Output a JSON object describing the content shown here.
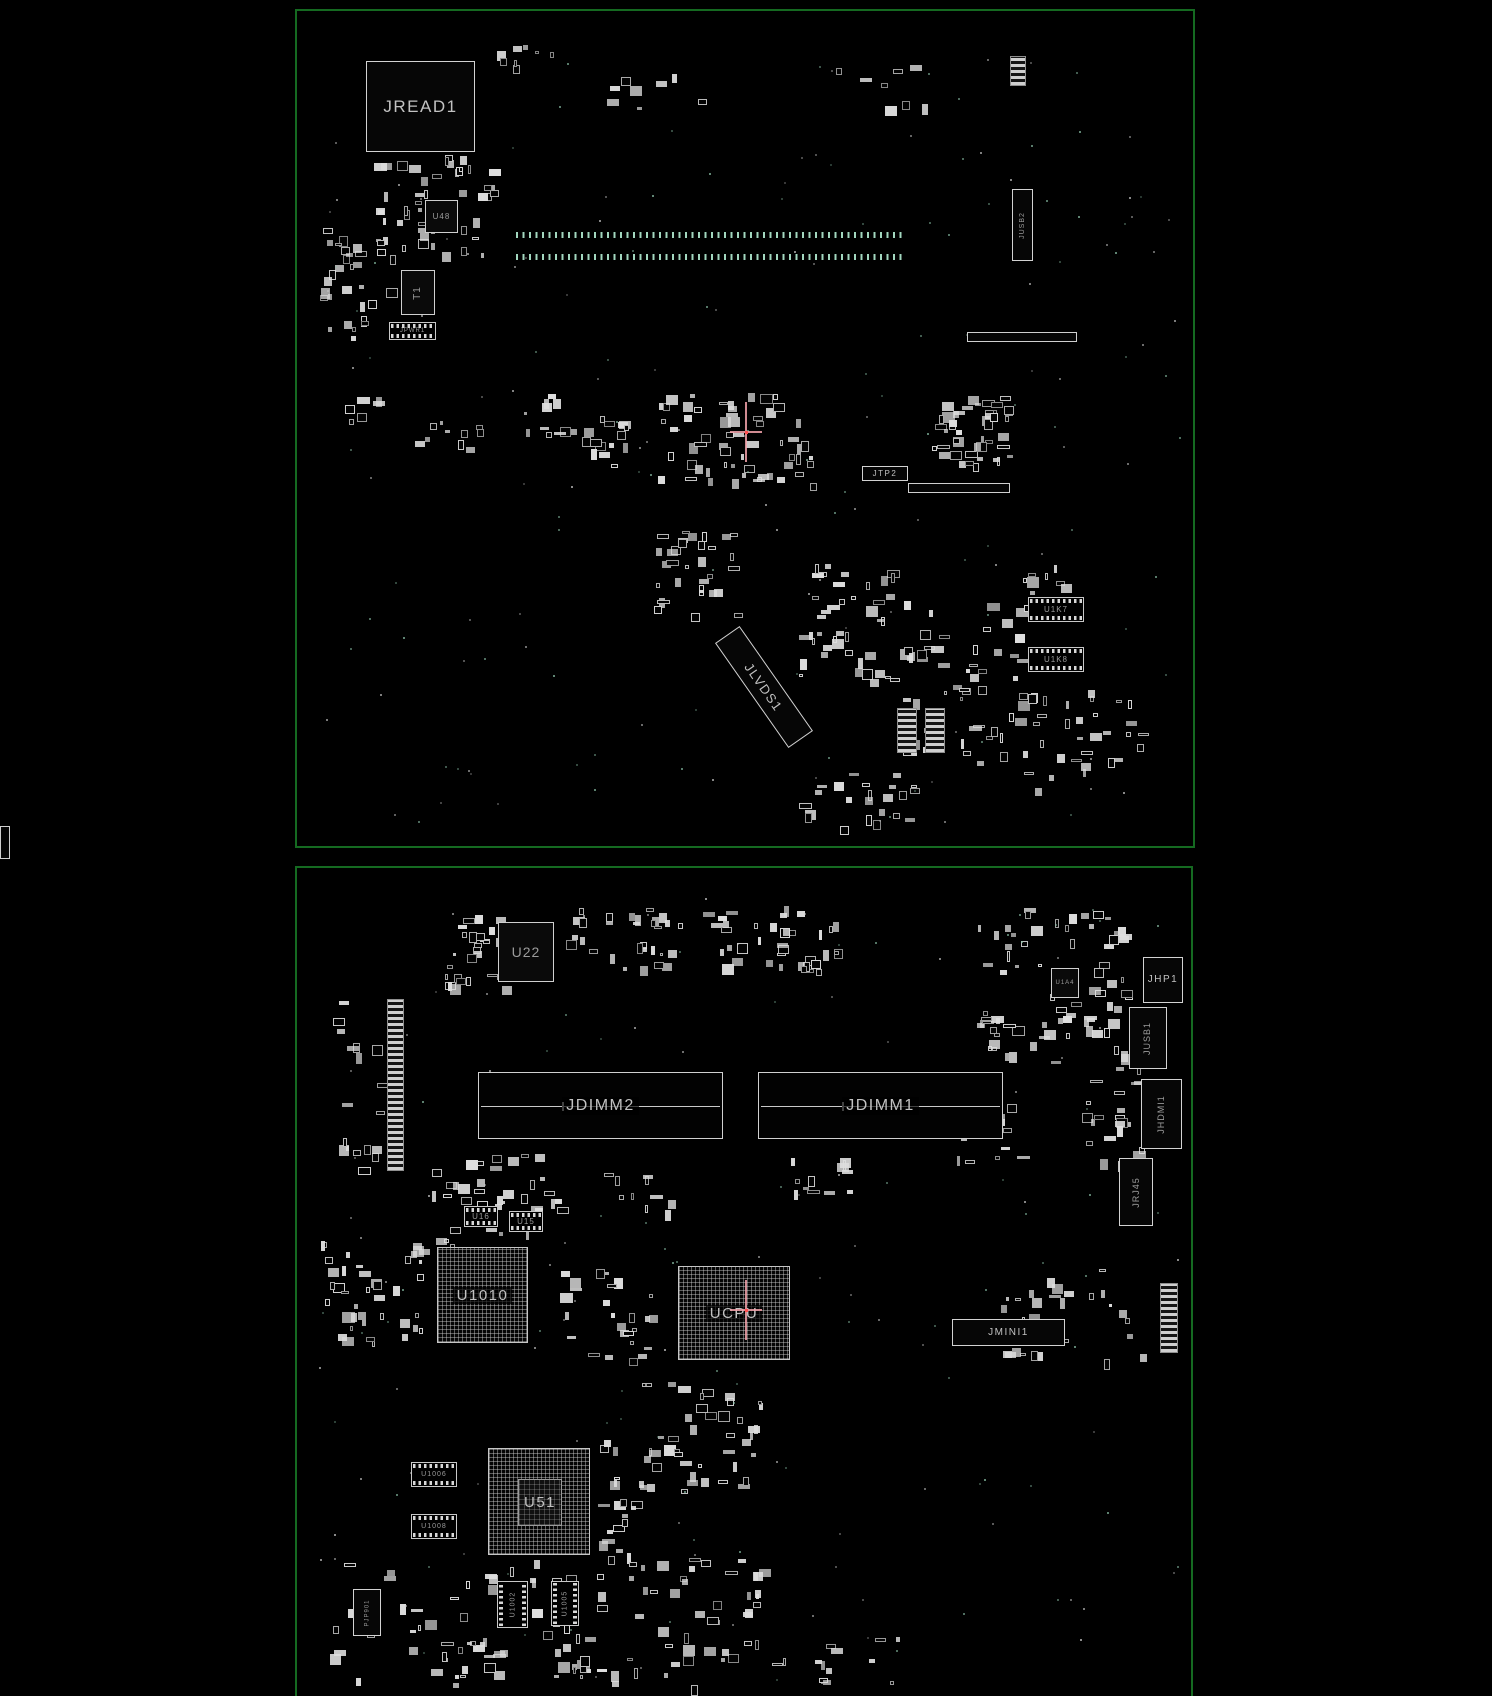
{
  "app": {
    "title": "PCB boardview diagram",
    "views": [
      "top-board",
      "bottom-board"
    ]
  },
  "colors": {
    "background": "#000000",
    "board_outline": "#156a21",
    "component_fill": "#d9d9d9",
    "component_outline": "#d2d2d2",
    "label_text": "#c2c2c2",
    "label_dim": "#9b9b9b",
    "pad_dot": "#8fc7ad",
    "crosshair_line": "#f5a3ab",
    "crosshair_center": "#ff4d4d"
  },
  "canvas": {
    "width": 1492,
    "height": 1688
  },
  "extras": [
    {
      "id": "screen-edge-part",
      "type": "bar",
      "x": 0,
      "y": 826,
      "w": 10,
      "h": 33
    }
  ],
  "boards": [
    {
      "id": "top-board",
      "outline": {
        "x": 295,
        "y": 9,
        "w": 900,
        "h": 839,
        "open": false
      },
      "crosshair": {
        "x": 746,
        "y": 432
      },
      "components": [
        {
          "id": "jread1",
          "label": "JREAD1",
          "type": "labelbox",
          "x": 366,
          "y": 61,
          "w": 109,
          "h": 91,
          "fs": 17
        },
        {
          "id": "u48",
          "label": "U48",
          "type": "chip",
          "x": 425,
          "y": 200,
          "w": 33,
          "h": 33,
          "fs": 8
        },
        {
          "id": "t1",
          "label": "T1",
          "type": "chip",
          "x": 401,
          "y": 270,
          "w": 34,
          "h": 45,
          "fs": 10,
          "vlabel": true
        },
        {
          "id": "jpwr1",
          "label": "JPWR1",
          "type": "stripeconn",
          "x": 389,
          "y": 322,
          "w": 47,
          "h": 18,
          "fs": 6
        },
        {
          "id": "jusb2",
          "label": "JUSB2",
          "type": "vlabelbox",
          "x": 1012,
          "y": 189,
          "w": 21,
          "h": 72,
          "fs": 7
        },
        {
          "id": "jtp2",
          "label": "JTP2",
          "type": "labelbox",
          "x": 862,
          "y": 466,
          "w": 46,
          "h": 15,
          "fs": 8
        },
        {
          "id": "jlvds1",
          "label": "JLVDS1",
          "type": "labelbox",
          "x": 700,
          "y": 672,
          "w": 128,
          "h": 30,
          "fs": 13,
          "boxrot": 55
        },
        {
          "id": "u1k7",
          "label": "U1K7",
          "type": "stripeconn",
          "x": 1028,
          "y": 597,
          "w": 56,
          "h": 25,
          "fs": 8
        },
        {
          "id": "u1k8",
          "label": "U1K8",
          "type": "stripeconn",
          "x": 1028,
          "y": 647,
          "w": 56,
          "h": 25,
          "fs": 8
        },
        {
          "id": "pad-row-1",
          "type": "dotrow",
          "x": 516,
          "y": 232,
          "w": 390,
          "h": 6
        },
        {
          "id": "pad-row-2",
          "type": "dotrow",
          "x": 516,
          "y": 254,
          "w": 390,
          "h": 6
        },
        {
          "id": "conn-bar-1",
          "type": "bar",
          "x": 967,
          "y": 332,
          "w": 110,
          "h": 10
        },
        {
          "id": "conn-bar-2",
          "type": "bar",
          "x": 908,
          "y": 483,
          "w": 102,
          "h": 10
        },
        {
          "id": "vconn-1",
          "type": "stripesv",
          "x": 1010,
          "y": 56,
          "w": 16,
          "h": 30
        },
        {
          "id": "vconn-2",
          "type": "stripesv",
          "x": 897,
          "y": 708,
          "w": 20,
          "h": 45
        },
        {
          "id": "vconn-3",
          "type": "stripesv",
          "x": 925,
          "y": 708,
          "w": 20,
          "h": 45
        }
      ],
      "decor": [
        {
          "x": 366,
          "y": 155,
          "w": 125,
          "h": 100,
          "n": 55,
          "seed": 11
        },
        {
          "x": 318,
          "y": 228,
          "w": 72,
          "h": 112,
          "n": 30,
          "seed": 12
        },
        {
          "x": 490,
          "y": 42,
          "w": 80,
          "h": 25,
          "n": 8,
          "seed": 13
        },
        {
          "x": 658,
          "y": 393,
          "w": 152,
          "h": 92,
          "n": 60,
          "seed": 14
        },
        {
          "x": 930,
          "y": 395,
          "w": 80,
          "h": 70,
          "n": 45,
          "seed": 15
        },
        {
          "x": 565,
          "y": 413,
          "w": 62,
          "h": 58,
          "n": 16,
          "seed": 16
        },
        {
          "x": 652,
          "y": 528,
          "w": 82,
          "h": 92,
          "n": 32,
          "seed": 17
        },
        {
          "x": 798,
          "y": 556,
          "w": 95,
          "h": 125,
          "n": 42,
          "seed": 18
        },
        {
          "x": 900,
          "y": 598,
          "w": 120,
          "h": 165,
          "n": 55,
          "seed": 19
        },
        {
          "x": 1015,
          "y": 560,
          "w": 55,
          "h": 55,
          "n": 18,
          "seed": 20
        },
        {
          "x": 793,
          "y": 770,
          "w": 122,
          "h": 60,
          "n": 24,
          "seed": 21
        },
        {
          "x": 1018,
          "y": 688,
          "w": 120,
          "h": 105,
          "n": 34,
          "seed": 22
        },
        {
          "x": 600,
          "y": 68,
          "w": 110,
          "h": 40,
          "n": 8,
          "seed": 24
        },
        {
          "x": 830,
          "y": 60,
          "w": 120,
          "h": 50,
          "n": 8,
          "seed": 25
        },
        {
          "x": 520,
          "y": 390,
          "w": 40,
          "h": 50,
          "n": 10,
          "seed": 26
        },
        {
          "x": 408,
          "y": 420,
          "w": 80,
          "h": 30,
          "n": 10,
          "seed": 27
        },
        {
          "x": 340,
          "y": 395,
          "w": 40,
          "h": 25,
          "n": 6,
          "seed": 28
        },
        {
          "x": 320,
          "y": 55,
          "w": 860,
          "h": 770,
          "n": 170,
          "seed": 23,
          "kind": "dots"
        }
      ]
    },
    {
      "id": "bottom-board",
      "outline": {
        "x": 295,
        "y": 866,
        "w": 898,
        "h": 830,
        "open": true
      },
      "crosshair": {
        "x": 746,
        "y": 1310
      },
      "components": [
        {
          "id": "u22",
          "label": "U22",
          "type": "chip",
          "x": 498,
          "y": 922,
          "w": 56,
          "h": 60,
          "fs": 14
        },
        {
          "id": "u1a4",
          "label": "U1A4",
          "type": "chip",
          "x": 1051,
          "y": 968,
          "w": 28,
          "h": 30,
          "fs": 6
        },
        {
          "id": "jhp1",
          "label": "JHP1",
          "type": "labelbox",
          "x": 1143,
          "y": 957,
          "w": 40,
          "h": 46,
          "fs": 10
        },
        {
          "id": "jusb1",
          "label": "JUSB1",
          "type": "vlabelbox",
          "x": 1129,
          "y": 1007,
          "w": 38,
          "h": 62,
          "fs": 9
        },
        {
          "id": "jhdmi1",
          "label": "JHDMI1",
          "type": "vlabelbox",
          "x": 1141,
          "y": 1079,
          "w": 41,
          "h": 70,
          "fs": 9
        },
        {
          "id": "jrj45",
          "label": "JRJ45",
          "type": "vlabelbox",
          "x": 1119,
          "y": 1158,
          "w": 34,
          "h": 68,
          "fs": 9
        },
        {
          "id": "jdimm2",
          "label": "JDIMM2",
          "type": "dimm",
          "x": 478,
          "y": 1072,
          "w": 245,
          "h": 67,
          "fs": 16
        },
        {
          "id": "jdimm1",
          "label": "JDIMM1",
          "type": "dimm",
          "x": 758,
          "y": 1072,
          "w": 245,
          "h": 67,
          "fs": 16
        },
        {
          "id": "u16",
          "label": "U16",
          "type": "stripeconn",
          "x": 464,
          "y": 1206,
          "w": 34,
          "h": 21,
          "fs": 8
        },
        {
          "id": "u15",
          "label": "U15",
          "type": "stripeconn",
          "x": 509,
          "y": 1211,
          "w": 34,
          "h": 21,
          "fs": 8
        },
        {
          "id": "u1010",
          "label": "U1010",
          "type": "bga",
          "x": 437,
          "y": 1247,
          "w": 91,
          "h": 96,
          "fs": 15
        },
        {
          "id": "ucpu",
          "label": "UCPU",
          "type": "bga",
          "x": 678,
          "y": 1266,
          "w": 112,
          "h": 94,
          "fs": 15
        },
        {
          "id": "jmini1",
          "label": "JMINI1",
          "type": "conn",
          "x": 952,
          "y": 1319,
          "w": 113,
          "h": 27,
          "fs": 10
        },
        {
          "id": "u51",
          "label": "U51",
          "type": "bga2",
          "x": 488,
          "y": 1448,
          "w": 102,
          "h": 107,
          "fs": 15
        },
        {
          "id": "u1006",
          "label": "U1006",
          "type": "stripeconn",
          "x": 411,
          "y": 1462,
          "w": 46,
          "h": 25,
          "fs": 7
        },
        {
          "id": "u1008",
          "label": "U1008",
          "type": "stripeconn",
          "x": 411,
          "y": 1514,
          "w": 46,
          "h": 25,
          "fs": 7
        },
        {
          "id": "pjp901",
          "label": "PJP901",
          "type": "vlabelbox",
          "x": 353,
          "y": 1589,
          "w": 28,
          "h": 47,
          "fs": 6
        },
        {
          "id": "u1002",
          "label": "U1002",
          "type": "stripeconnv",
          "x": 497,
          "y": 1581,
          "w": 31,
          "h": 47,
          "fs": 7
        },
        {
          "id": "u1005",
          "label": "U1005",
          "type": "stripeconnv",
          "x": 551,
          "y": 1581,
          "w": 28,
          "h": 45,
          "fs": 7
        },
        {
          "id": "batt-conn",
          "type": "stripesv",
          "x": 387,
          "y": 999,
          "w": 17,
          "h": 172
        },
        {
          "id": "edge-conn",
          "type": "stripesv",
          "x": 1160,
          "y": 1283,
          "w": 18,
          "h": 70
        }
      ],
      "decor": [
        {
          "x": 440,
          "y": 903,
          "w": 70,
          "h": 85,
          "n": 30,
          "seed": 31
        },
        {
          "x": 565,
          "y": 905,
          "w": 115,
          "h": 62,
          "n": 30,
          "seed": 32
        },
        {
          "x": 700,
          "y": 905,
          "w": 140,
          "h": 65,
          "n": 38,
          "seed": 33
        },
        {
          "x": 975,
          "y": 903,
          "w": 150,
          "h": 158,
          "n": 80,
          "seed": 34
        },
        {
          "x": 1082,
          "y": 1062,
          "w": 58,
          "h": 100,
          "n": 22,
          "seed": 35
        },
        {
          "x": 788,
          "y": 1152,
          "w": 62,
          "h": 40,
          "n": 12,
          "seed": 36
        },
        {
          "x": 320,
          "y": 1238,
          "w": 100,
          "h": 100,
          "n": 40,
          "seed": 37
        },
        {
          "x": 432,
          "y": 1150,
          "w": 130,
          "h": 95,
          "n": 40,
          "seed": 38
        },
        {
          "x": 560,
          "y": 1268,
          "w": 100,
          "h": 90,
          "n": 26,
          "seed": 39
        },
        {
          "x": 600,
          "y": 1168,
          "w": 70,
          "h": 45,
          "n": 10,
          "seed": 40
        },
        {
          "x": 640,
          "y": 1382,
          "w": 120,
          "h": 112,
          "n": 40,
          "seed": 41
        },
        {
          "x": 598,
          "y": 1438,
          "w": 55,
          "h": 140,
          "n": 26,
          "seed": 42
        },
        {
          "x": 330,
          "y": 1555,
          "w": 320,
          "h": 128,
          "n": 60,
          "seed": 43
        },
        {
          "x": 645,
          "y": 1550,
          "w": 130,
          "h": 135,
          "n": 34,
          "seed": 44
        },
        {
          "x": 1000,
          "y": 1268,
          "w": 140,
          "h": 92,
          "n": 30,
          "seed": 45
        },
        {
          "x": 418,
          "y": 1640,
          "w": 230,
          "h": 45,
          "n": 20,
          "seed": 47
        },
        {
          "x": 700,
          "y": 1630,
          "w": 200,
          "h": 55,
          "n": 16,
          "seed": 48
        },
        {
          "x": 320,
          "y": 1000,
          "w": 60,
          "h": 170,
          "n": 18,
          "seed": 49
        },
        {
          "x": 940,
          "y": 1100,
          "w": 90,
          "h": 60,
          "n": 14,
          "seed": 50
        },
        {
          "x": 315,
          "y": 895,
          "w": 865,
          "h": 790,
          "n": 160,
          "seed": 46,
          "kind": "dots"
        }
      ]
    }
  ]
}
